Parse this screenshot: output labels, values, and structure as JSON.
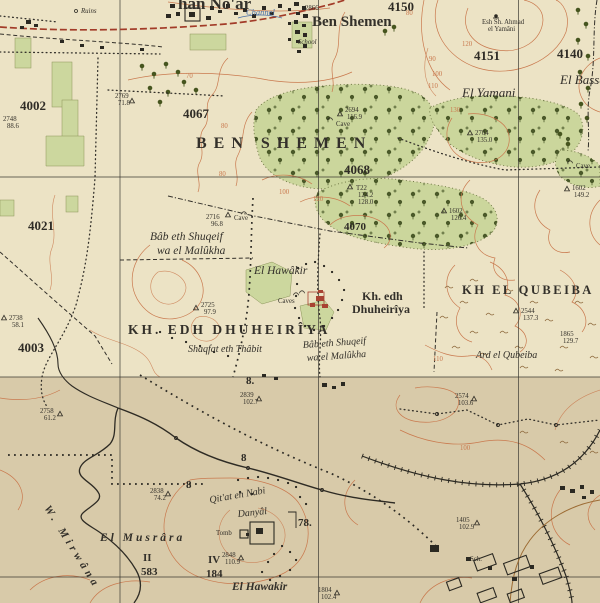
{
  "map": {
    "region_title": "BEN SHEMEN",
    "colors": {
      "paper_top": "#ece3c5",
      "paper_bottom": "#d8caa9",
      "forest_green": "#cbd69c",
      "contour_orange": "#c9794e",
      "road_red": "#a23b28",
      "ink": "#33302a",
      "water_blue": "#4a6fa5",
      "ruin_red": "#a84232"
    },
    "place_labels": {
      "kfar_hanoar": "han No'ar",
      "ben_shemen_village": "Ben Shemen",
      "channel": "Channel",
      "ruins": "Ruins",
      "school": "School",
      "sheikh_line1": "Esh Sh. Ahmad",
      "sheikh_line2": "el Yamâni",
      "ben_shemen_forest": "BEN SHEMEN",
      "el_yamani": "El Yamani",
      "el_bassa": "El Bassa",
      "bab_north_line1": "Bâb eth Shuqeif",
      "bab_north_line2": "wa el Malûkha",
      "el_hawakir_north": "El Hawâkir",
      "kh_edh_line1": "Kh. edh",
      "kh_edh_line2": "Dhuheirîya",
      "kh_edh_big": "KH. EDH DHUHEIRÎYA",
      "shaqfat": "Shaqfat eth Thâbit",
      "bab_south_line1": "Bâb eth Shuqeif",
      "bab_south_line2": "wa el Malûkha",
      "kh_el_qubeiba": "KH  EL QUBEIBA",
      "ard_el_qubeiba": "Ard el Qubeiba",
      "w_mirwana": "W. Mirwâna",
      "el_musrara": "El Musrâra",
      "numeral_ii": "II",
      "num_583": "583",
      "numeral_iv": "IV",
      "nabi_line1": "Qit'at en Nabi",
      "nabi_line2": "Danyâl",
      "tomb": "Tomb",
      "el_hawakir_south": "El Hawakir",
      "sch": "Sch.",
      "num_78": "78.",
      "num_184": "184",
      "num_8a": "8.",
      "num_8b": "8",
      "num_8c": "8",
      "cave_a": "Cave",
      "cave_b": "Cave",
      "cave_c": "Caves",
      "cave_d": "Cave"
    },
    "block_numbers": {
      "b4002": "4002",
      "b4003": "4003",
      "b4021": "4021",
      "b4067": "4067",
      "b4068": "4068",
      "b4070": "4070",
      "b4140": "4140",
      "b4150": "4150",
      "b4151": "4151"
    },
    "contour_labels": {
      "c70": "70",
      "c80a": "80",
      "c80b": "80",
      "c80c": "80",
      "c90": "90",
      "c100a": "100",
      "c110a": "110",
      "c120a": "120",
      "c130": "130",
      "c100b": "100",
      "c120b": "120",
      "c110b": "110",
      "c100c": "100"
    },
    "spot_heights": {
      "s2866": {
        "v": "2866"
      },
      "s2748": {
        "v": "2748",
        "h": "88.6"
      },
      "s2769": {
        "v": "2769",
        "h": "71.8"
      },
      "s2694": {
        "v": "2694",
        "h": "116.9"
      },
      "t22": {
        "v": "T22",
        "m": "124.2",
        "h": "128.0"
      },
      "s1602": {
        "v": "1602",
        "h": "126.4"
      },
      "s2704": {
        "v": "2704",
        "h": "135.0"
      },
      "s1608": {
        "v": "1602",
        "h": "149.2"
      },
      "s2716": {
        "v": "2716",
        "h": "96.8"
      },
      "s2725": {
        "v": "2725",
        "h": "97.9"
      },
      "s2544": {
        "v": "2544",
        "h": "137.3"
      },
      "s1865": {
        "v": "1865",
        "h": "129.7"
      },
      "s2738": {
        "v": "2738",
        "h": "58.1"
      },
      "s2758": {
        "v": "2758",
        "h": "61.2"
      },
      "s2574": {
        "v": "2574",
        "h": "103.6"
      },
      "s2839": {
        "v": "2839",
        "h": "102.7"
      },
      "s2838": {
        "v": "2838",
        "h": "74.2"
      },
      "s2848": {
        "v": "2848",
        "h": "110.9"
      },
      "s1804": {
        "v": "1804",
        "h": "102.4"
      },
      "s1405": {
        "v": "1405",
        "h": "102.9"
      }
    }
  }
}
